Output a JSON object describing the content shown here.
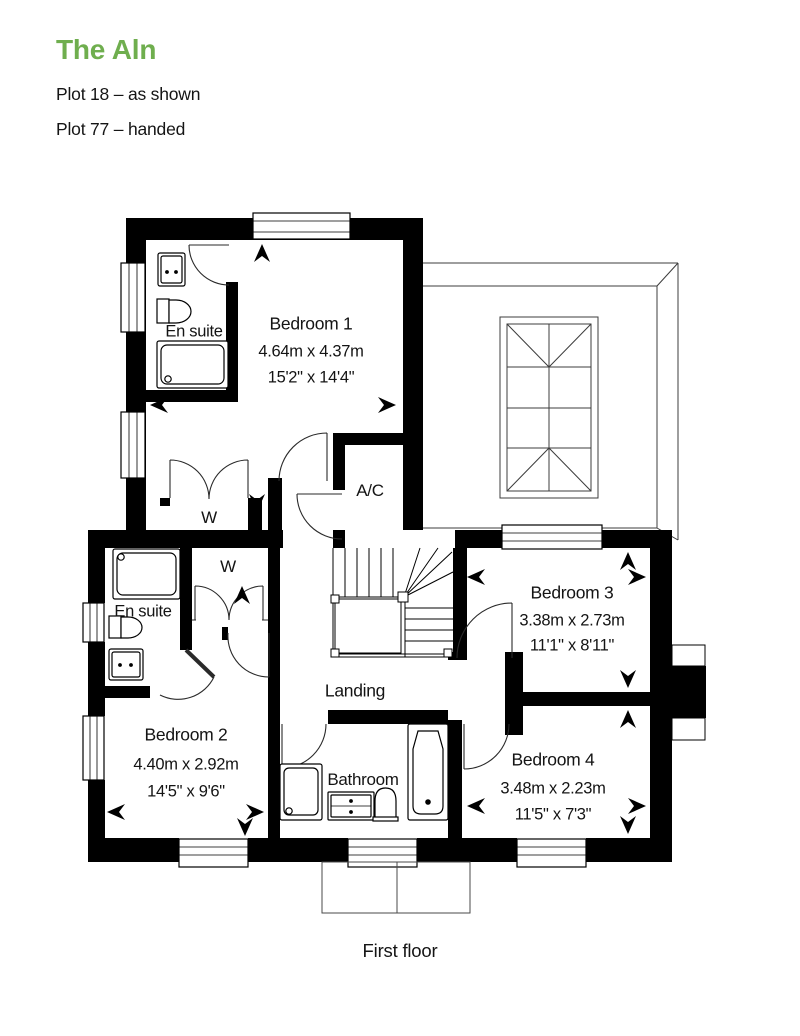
{
  "header": {
    "title": "The Aln",
    "accent_color": "#6fae4e",
    "plot_lines": [
      "Plot 18 – as shown",
      "Plot 77 – handed"
    ]
  },
  "caption": "First floor",
  "rooms": {
    "bedroom1": {
      "label": "Bedroom 1",
      "metric": "4.64m x 4.37m",
      "imperial": "15'2\" x 14'4\""
    },
    "bedroom2": {
      "label": "Bedroom 2",
      "metric": "4.40m x 2.92m",
      "imperial": "14'5\" x 9'6\""
    },
    "bedroom3": {
      "label": "Bedroom 3",
      "metric": "3.38m x 2.73m",
      "imperial": "11'1\" x 8'11\""
    },
    "bedroom4": {
      "label": "Bedroom 4",
      "metric": "3.48m x 2.23m",
      "imperial": "11'5\" x 7'3\""
    },
    "ensuite1": {
      "label": "En suite"
    },
    "ensuite2": {
      "label": "En suite"
    },
    "bathroom": {
      "label": "Bathroom"
    },
    "landing": {
      "label": "Landing"
    },
    "ac": {
      "label": "A/C"
    },
    "wardrobe1": {
      "label": "W"
    },
    "wardrobe2": {
      "label": "W"
    }
  }
}
